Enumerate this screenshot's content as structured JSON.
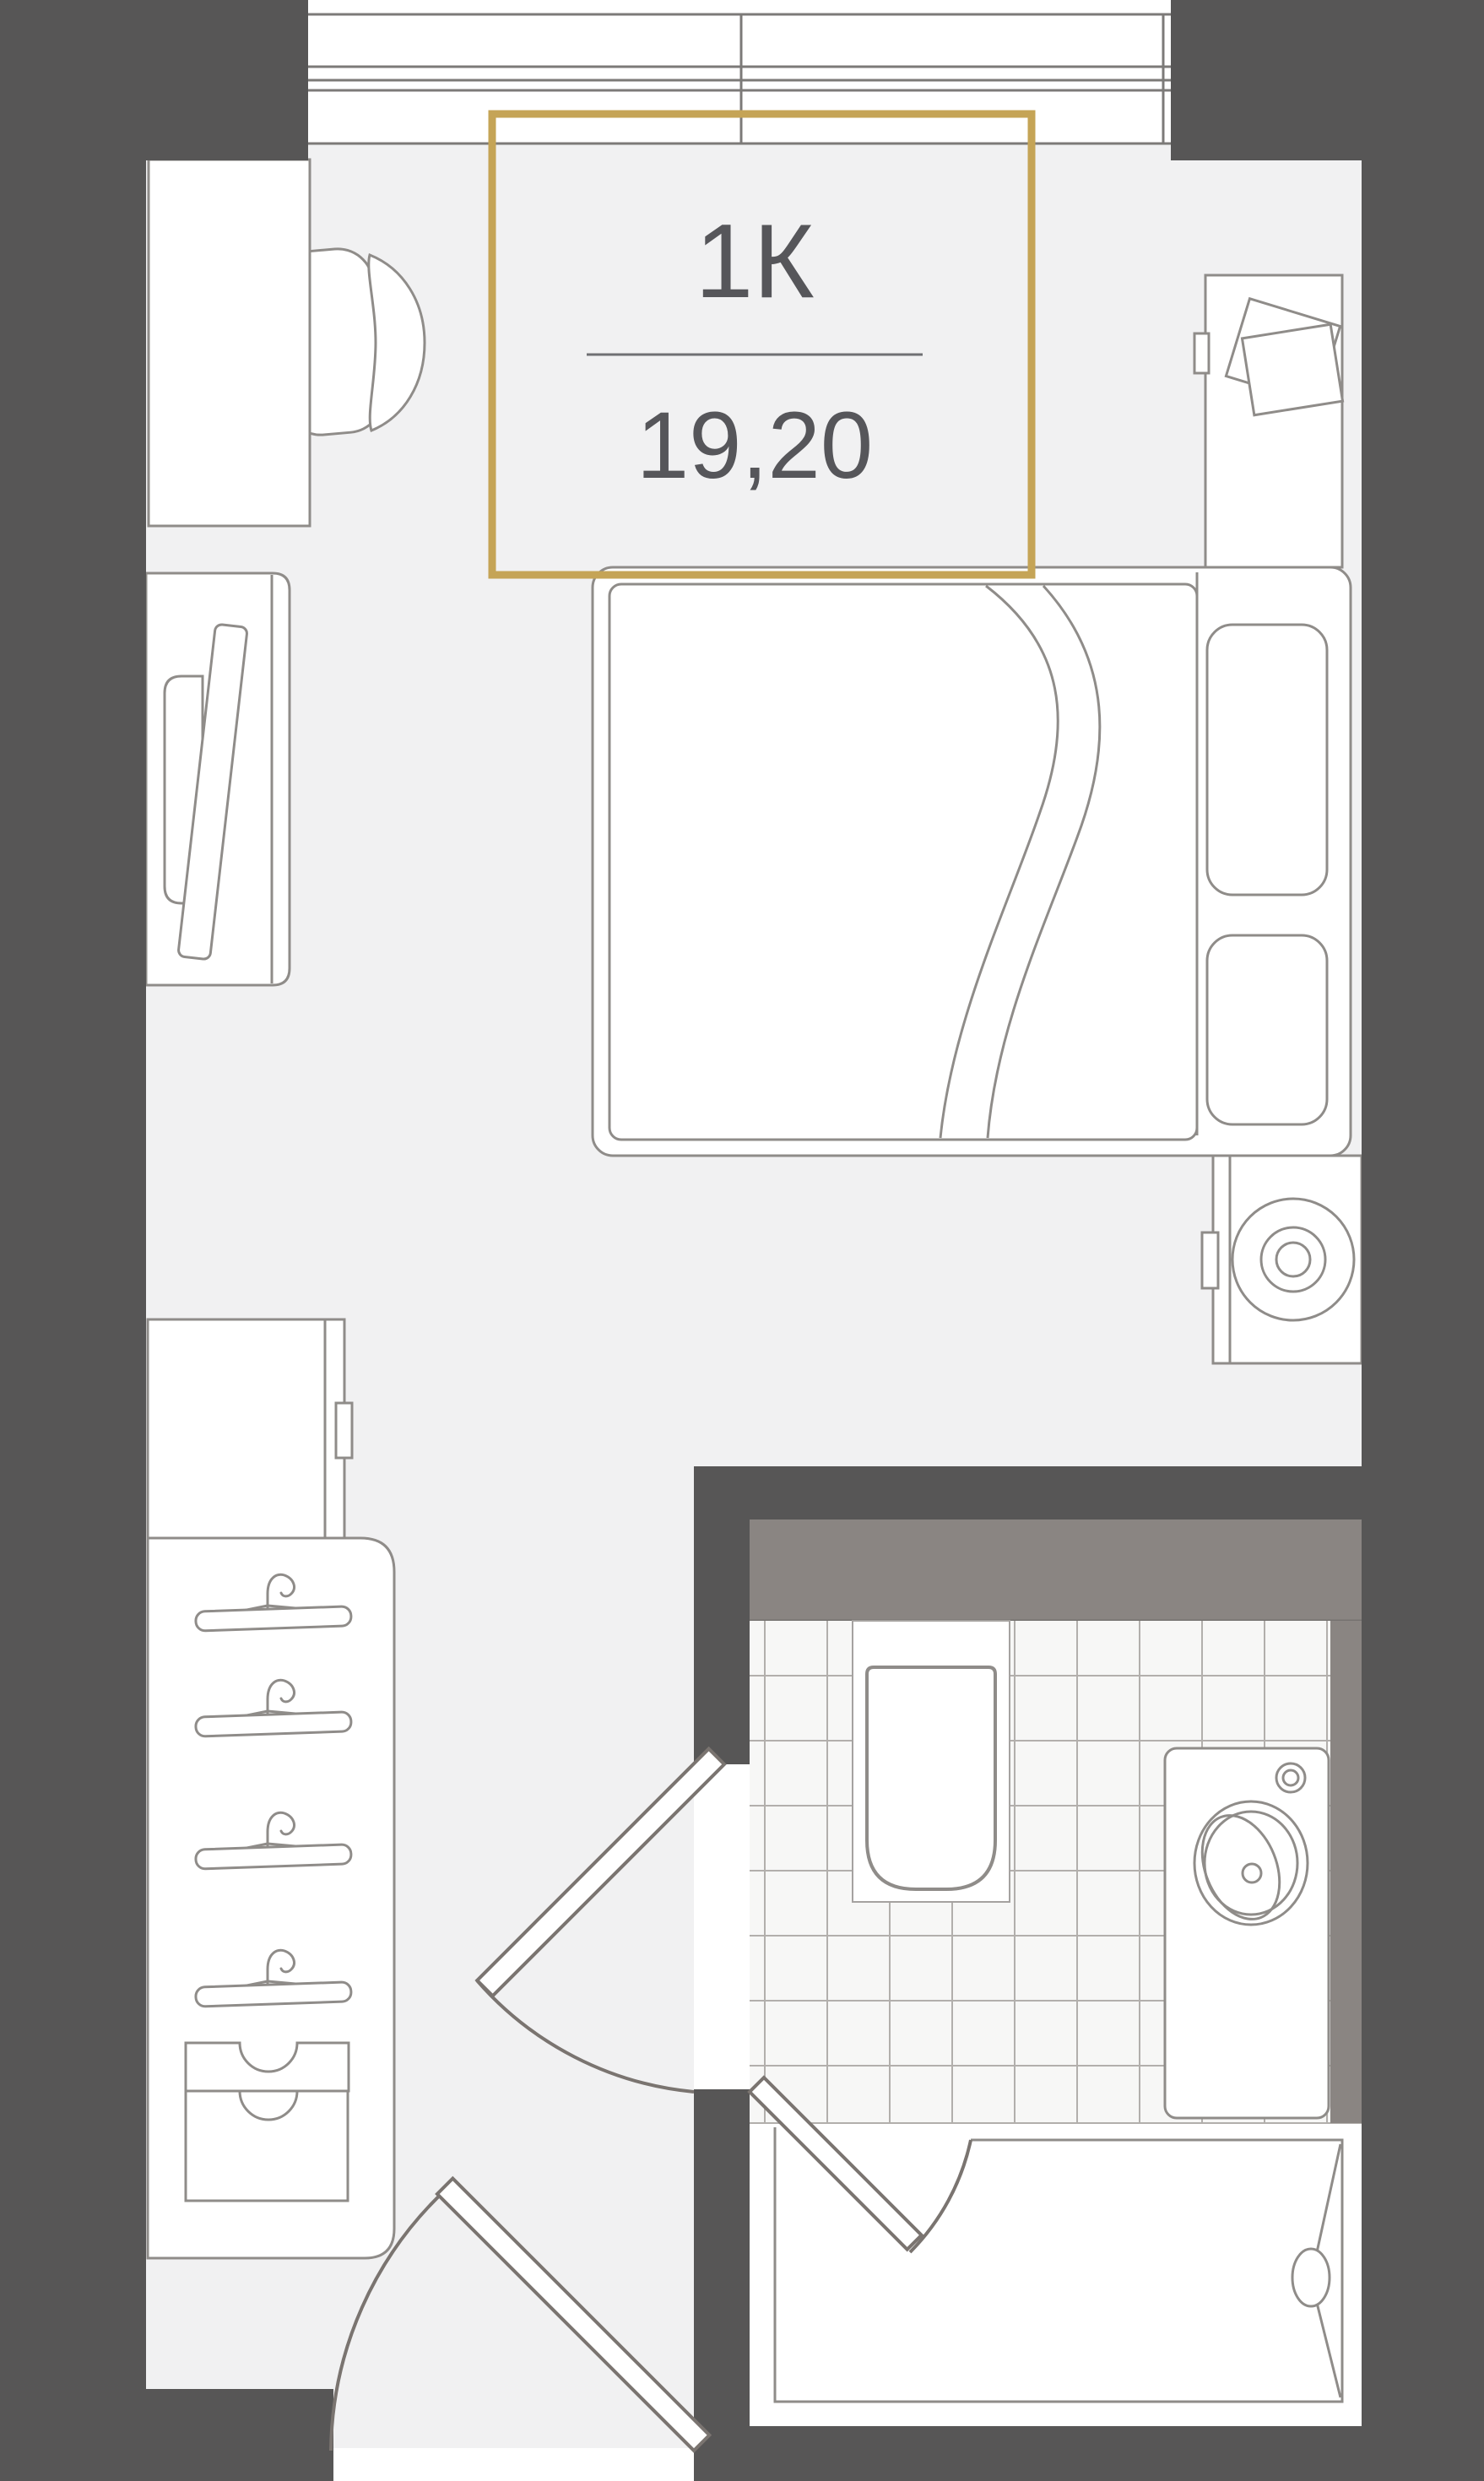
{
  "plan": {
    "unit_label": "1К",
    "area": "19,20"
  },
  "colors": {
    "wall_dark": "#575656",
    "accent_gold": "#c5a456",
    "room_fill": "#f1f1f2",
    "furniture_line": "#8f8c89",
    "window_line": "#7c7a78",
    "door_line": "#7a7470",
    "wet_band": "#8a8582",
    "tile_fill": "#f7f7f6",
    "tile_line": "#b2afac",
    "label_text": "#56565a"
  },
  "elements": {
    "window": "window-top",
    "desk": "desk",
    "chair": "desk-chair",
    "tv": "tv-panel",
    "bed": "double-bed",
    "nightstand": "nightstand",
    "washer": "washing-machine",
    "fridge": "tall-cabinet",
    "wardrobe": "wardrobe-with-hangers",
    "toilet": "toilet",
    "sink": "sink-vanity",
    "bathtub": "bathtub",
    "doors": [
      "entry-door",
      "bathroom-door",
      "tub-screen"
    ]
  }
}
